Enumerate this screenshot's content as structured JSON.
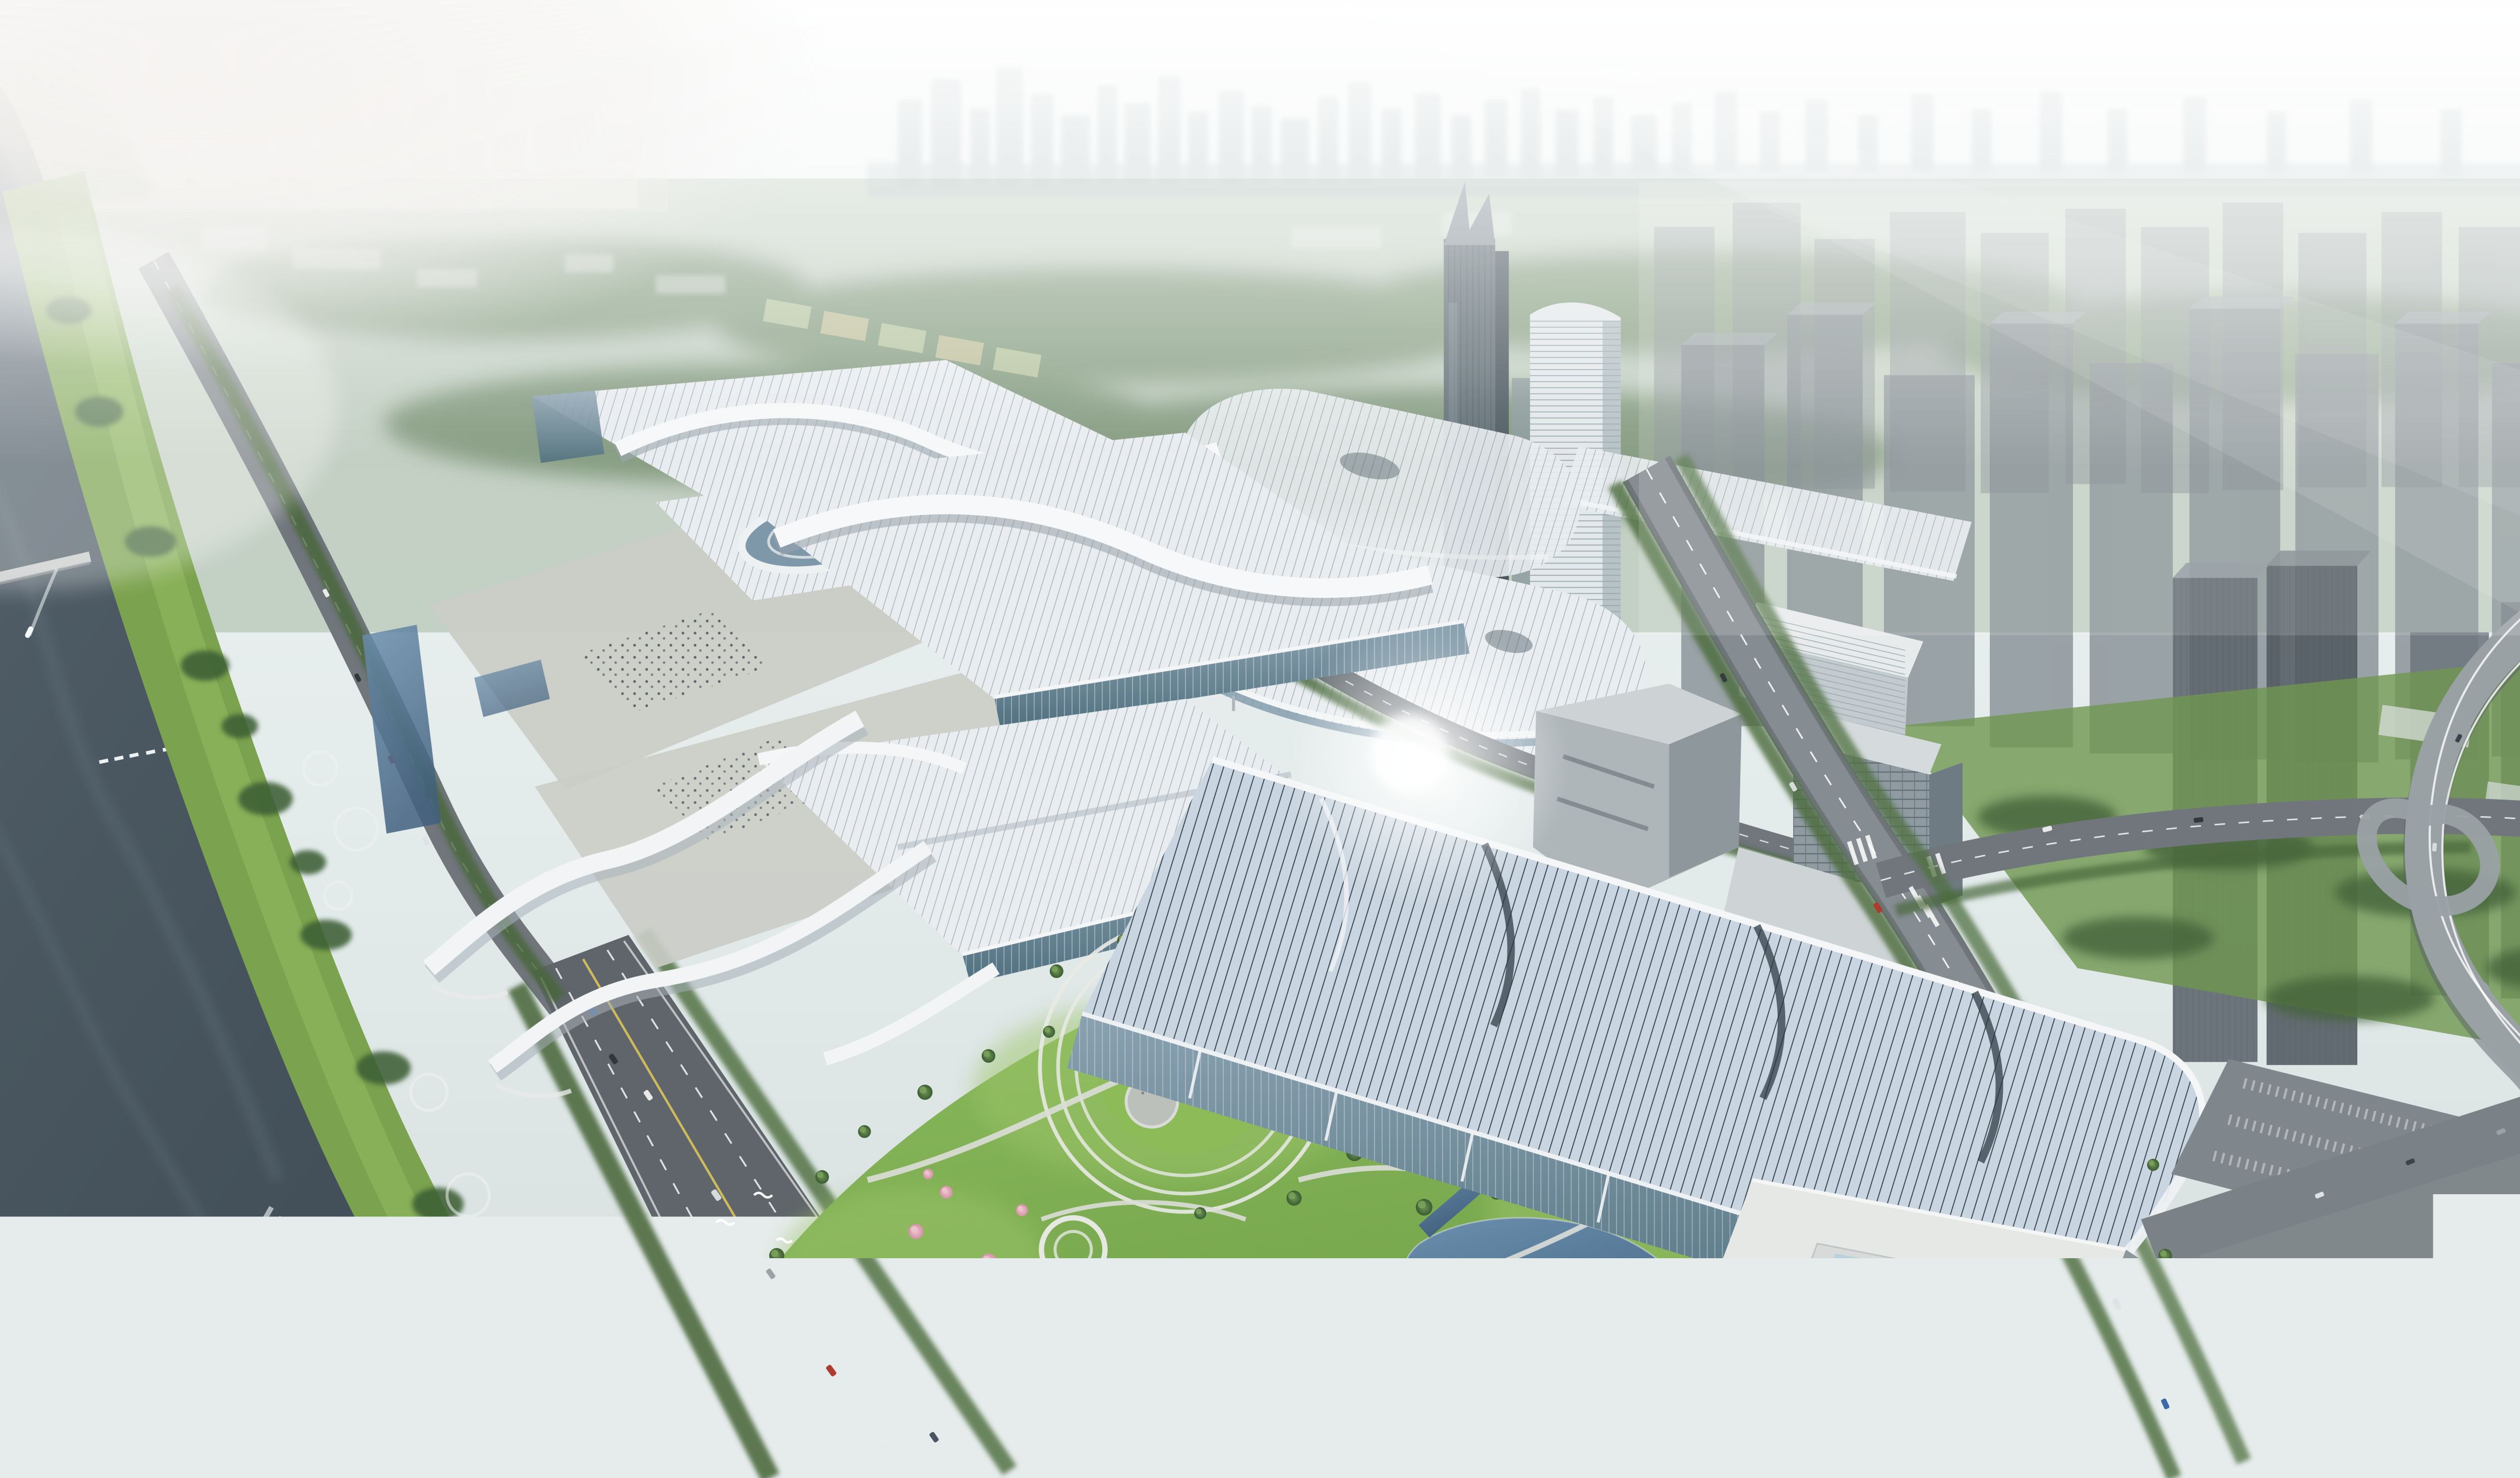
{
  "scene": {
    "title": "Aerial rendering of a riverside exhibition center complex with wavy white hall roofs, central park, city towers, boulevards and a river",
    "landmarks": [
      "river",
      "river-boat",
      "riverbank-greenway",
      "riverside-avenue",
      "exhibition-halls-west",
      "ribbon-walkways",
      "oval-atrium-hall",
      "pill-roof-halls",
      "link-bridge",
      "foreground-exhibition-hall",
      "annex-building",
      "central-park",
      "amphitheater-lawn",
      "ponds",
      "cherry-blossom-trees",
      "bird-flock",
      "crown-top-tower",
      "striped-tower",
      "city-tower-field",
      "boulevard",
      "cross-street",
      "expressway-interchange",
      "parking-plaza"
    ]
  },
  "colors": {
    "sky_top": "#f3f6f5",
    "sky_mid": "#e2eaea",
    "far_city": "#93a5aa",
    "water_dark": "#49565f",
    "water_mid": "#566470",
    "water_light": "#67757e",
    "bank_grass": "#7ba24e",
    "park_grass": "#7cae52",
    "park_grass_light": "#9cc468",
    "tree_dark": "#3f6136",
    "tree_mid": "#55764a",
    "tree_hi": "#7da55c",
    "blossom": "#d294a6",
    "blossom_hi": "#ecc3cd",
    "roof_white": "#e9edf0",
    "roof_rib": "#a8b2ba",
    "roof_blue": "#c9d5e0",
    "roof_blue_rib": "#39454f",
    "glass_wall": "#6c8496",
    "facade_white": "#dfe3e4",
    "road": "#70767b",
    "road_dark": "#5f656a",
    "road_light": "#9aa1a5",
    "marking": "#ffffff",
    "center_line": "#d8c35a",
    "plaza": "#cbcdc7",
    "pond_light": "#6b8fae",
    "pond_dark": "#42617f",
    "tower_glass": "#5f6d75",
    "tower_gray": "#7c858b",
    "tower_top": "#9aa3a8",
    "parking": "#7b8287",
    "boat": "#f7f9f9",
    "haze": "#ffffff"
  }
}
